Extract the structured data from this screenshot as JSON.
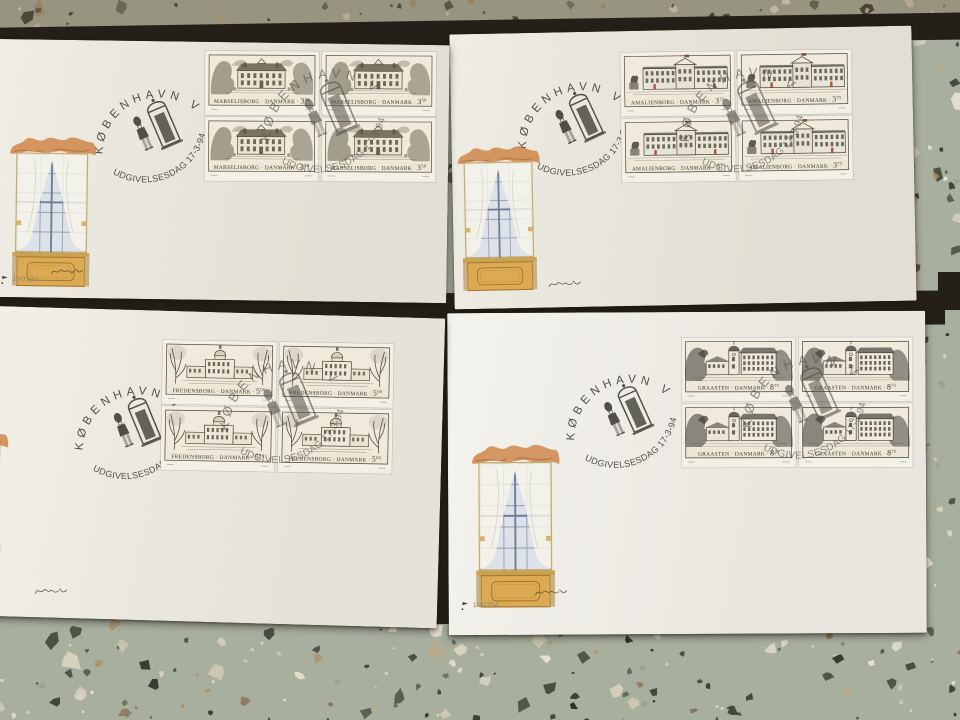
{
  "postmark": {
    "place": "KØBENHAVN V",
    "event": "UDGIVELSESDAG 17-3-94"
  },
  "envelopes": [
    {
      "id": "marselisborg",
      "caption": "MARSELISBORG · DANMARK ·",
      "denom_major": "3",
      "denom_minor": "50",
      "stamp_count": 4,
      "ink": "#55523e"
    },
    {
      "id": "amalienborg",
      "caption": "AMALIENBORG · DANMARK ·",
      "denom_major": "3",
      "denom_minor": "75",
      "stamp_count": 4,
      "ink": "#4c4a40",
      "accent": "#a63c2c"
    },
    {
      "id": "fredensborg",
      "caption": "FREDENSBORG · DANMARK ·",
      "denom_major": "5",
      "denom_minor": "00",
      "stamp_count": 4,
      "ink": "#4a4636"
    },
    {
      "id": "graasten",
      "caption": "GRAASTEN · DANMARK ·",
      "denom_major": "8",
      "denom_minor": "75",
      "stamp_count": 4,
      "ink": "#45443c"
    }
  ],
  "imprint": {
    "code": "190394"
  },
  "colors": {
    "envelope_paper": "#eeebe1",
    "album_dark": "#242019",
    "postmark_ink": "#504f47",
    "terrazzo_base": "#a9af9f",
    "valance_orange": "#cd8040",
    "panel_gold": "#dcaa52",
    "flag_red": "#a63c2c"
  }
}
